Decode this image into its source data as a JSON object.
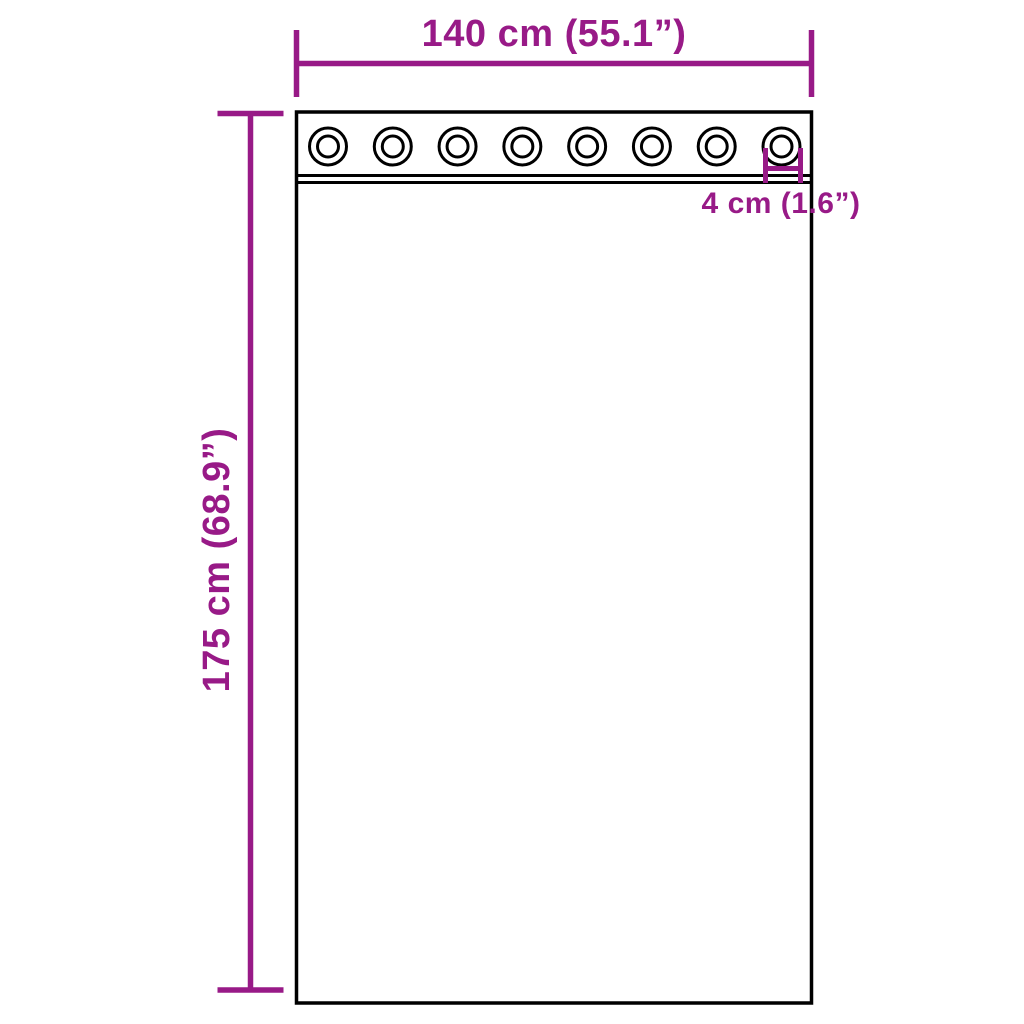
{
  "diagram": {
    "width_label": "140 cm (55.1”)",
    "height_label": "175 cm (68.9”)",
    "grommet_diameter_label": "4 cm (1.6”)",
    "grommet_count": 8,
    "colors": {
      "dimension": "#981a87",
      "outline": "#000000",
      "background": "#ffffff"
    }
  }
}
